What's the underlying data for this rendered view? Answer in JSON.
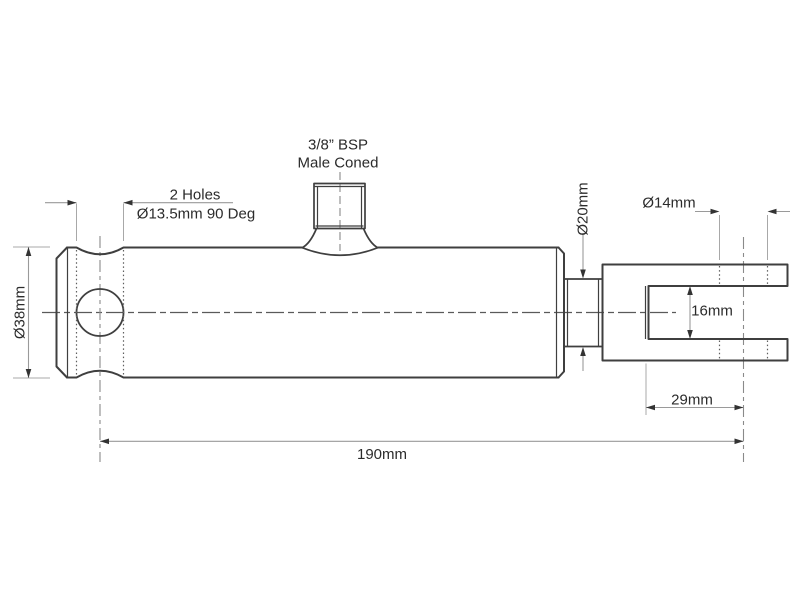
{
  "labels": {
    "port_line1": "3/8” BSP",
    "port_line2": "Male Coned",
    "holes_line1": "2 Holes",
    "holes_line2": "Ø13.5mm 90 Deg",
    "body_diameter": "Ø38mm",
    "rod_diameter": "Ø20mm",
    "pin_hole_diameter": "Ø14mm",
    "jaw_gap": "16mm",
    "jaw_depth": "29mm",
    "overall_length": "190mm"
  },
  "colors": {
    "background": "#ffffff",
    "part_outline": "#3f3f3f",
    "dimension_lines": "#9a9a9a",
    "text": "#2b2b2b"
  }
}
